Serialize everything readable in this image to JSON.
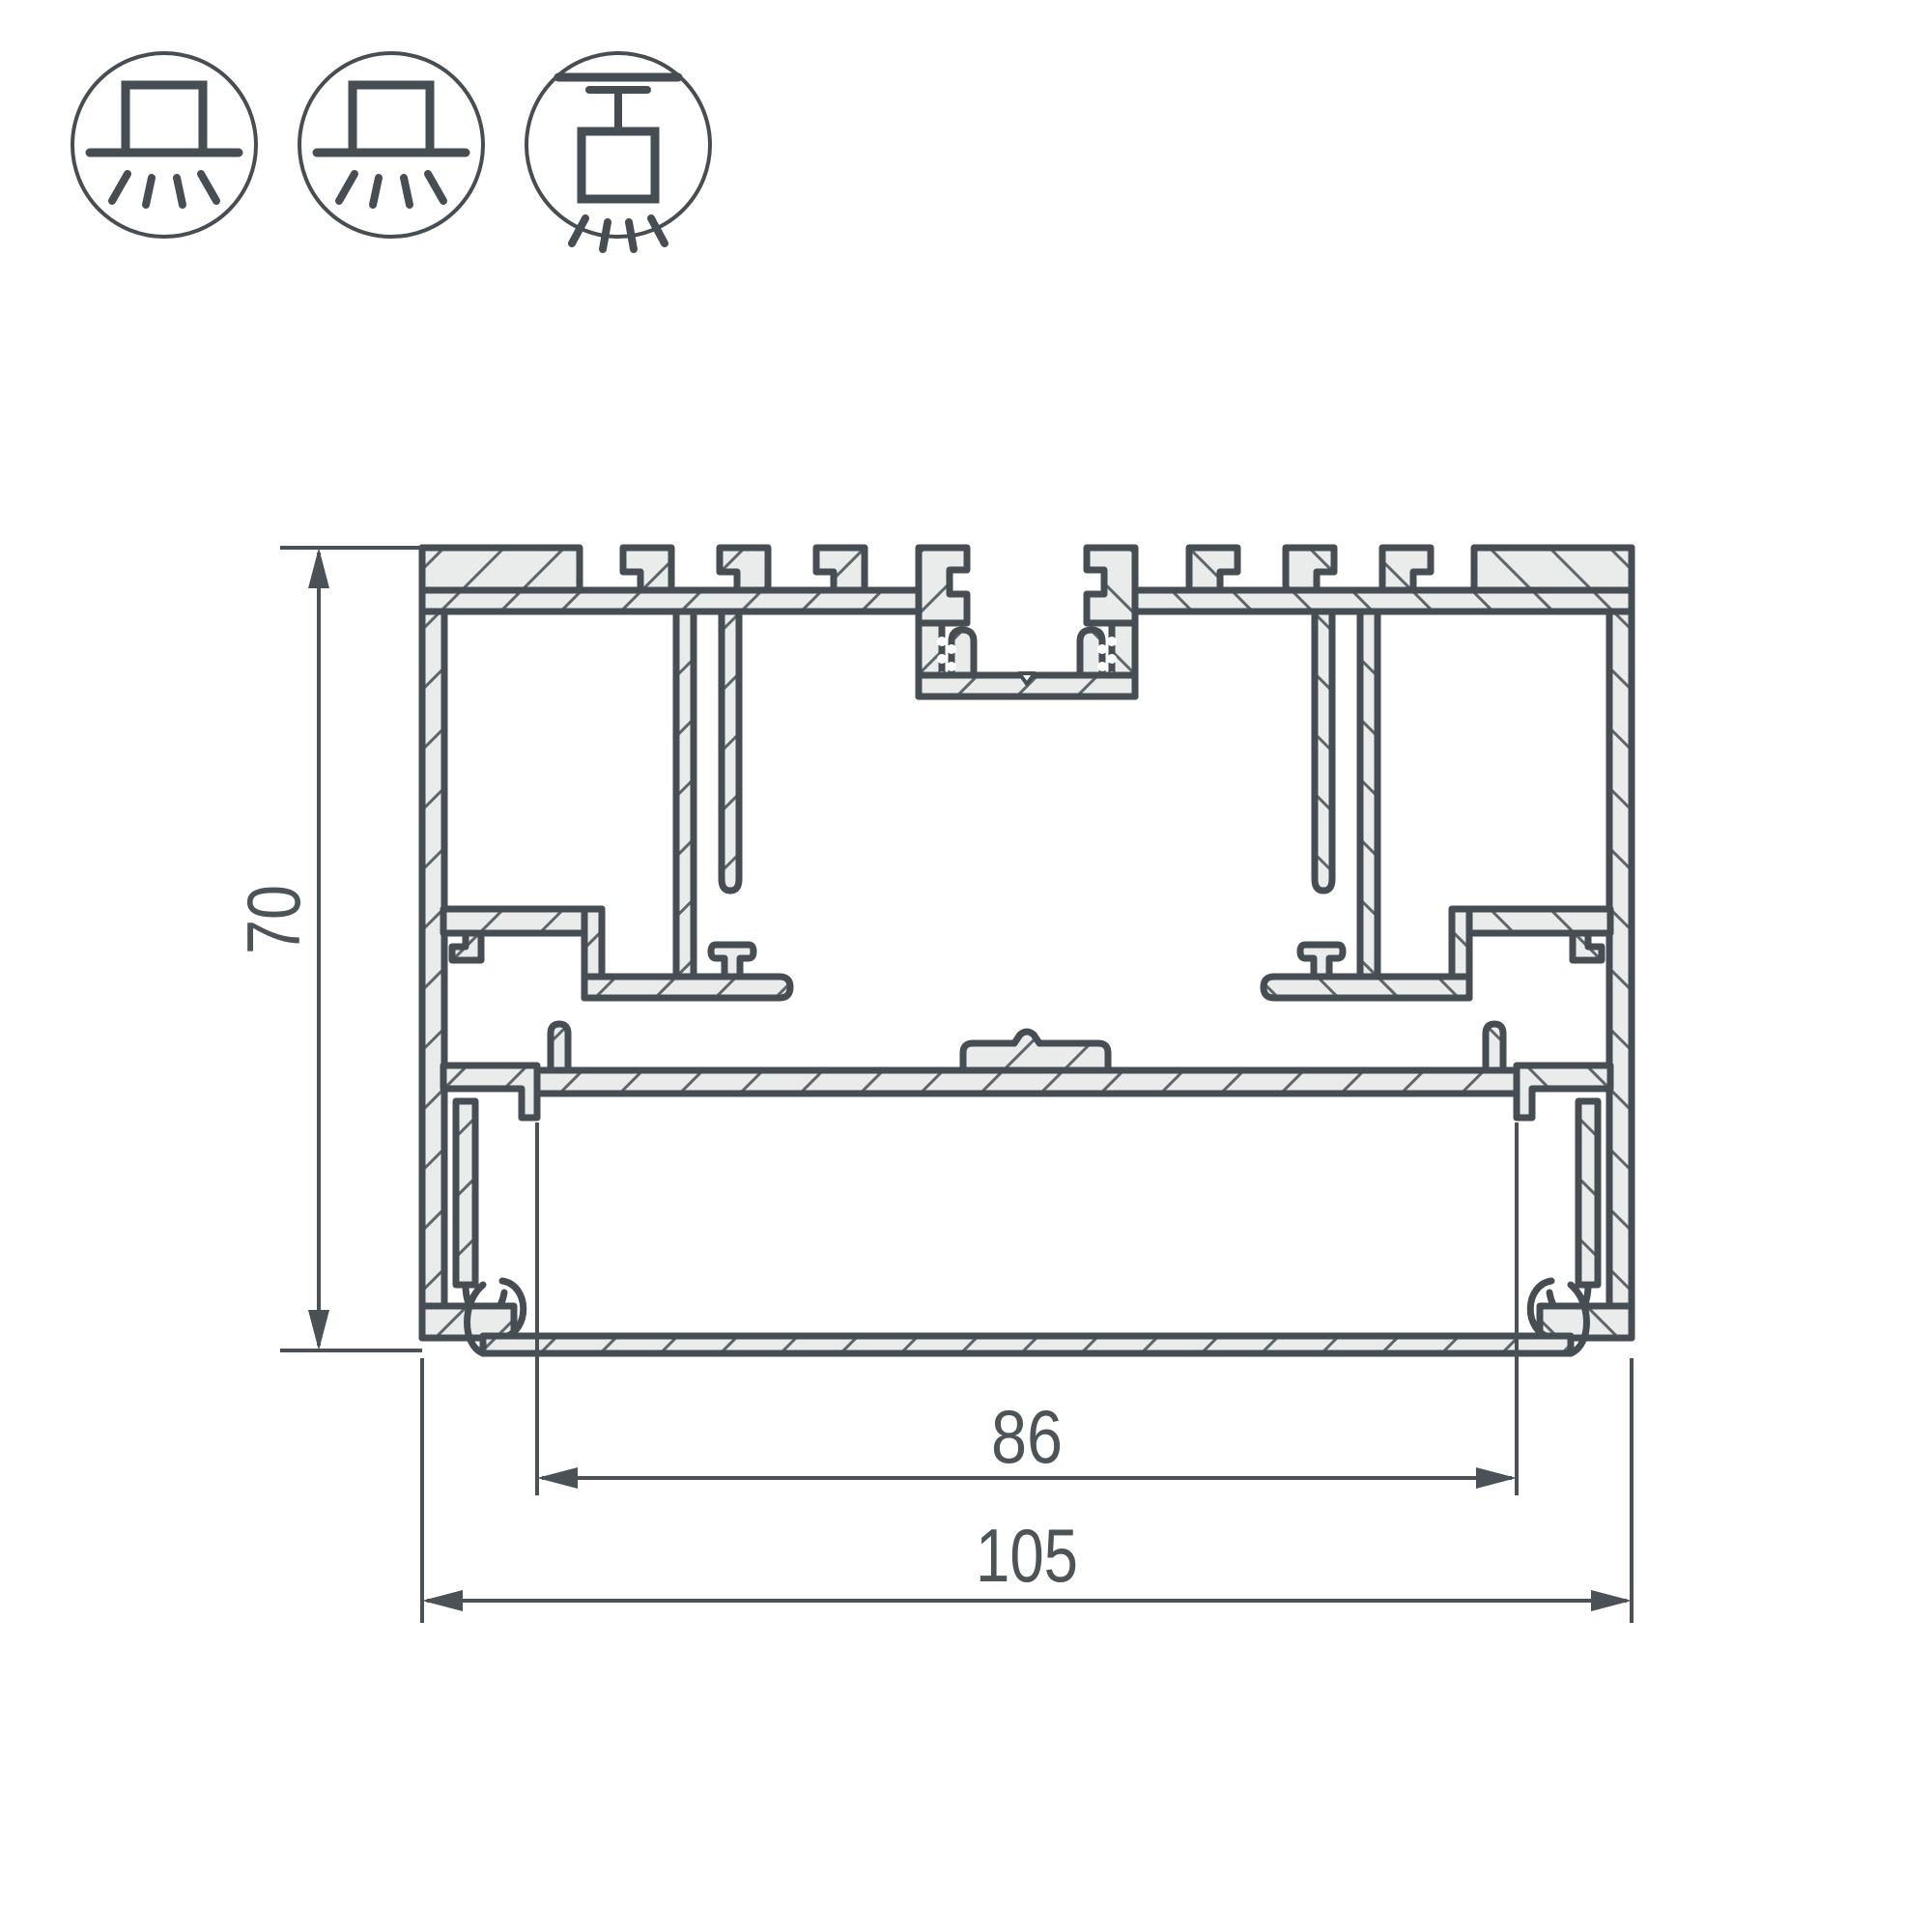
{
  "page": {
    "background": "#ffffff",
    "description": "Technical cross-section drawing of aluminum linear LED profile with mounting icons and dimensions"
  },
  "colors": {
    "line": "#474e53",
    "metal_fill": "#eaeceb",
    "hatch_stroke": "#5d666b",
    "text": "#4d5458"
  },
  "icons": [
    {
      "name": "surface-mount-light"
    },
    {
      "name": "surface-mount-light"
    },
    {
      "name": "pendant-mount-light"
    }
  ],
  "dimensions": {
    "height": "70",
    "inner_width": "86",
    "outer_width": "105"
  },
  "drawing": {
    "type": "extrusion-profile-cross-section"
  }
}
